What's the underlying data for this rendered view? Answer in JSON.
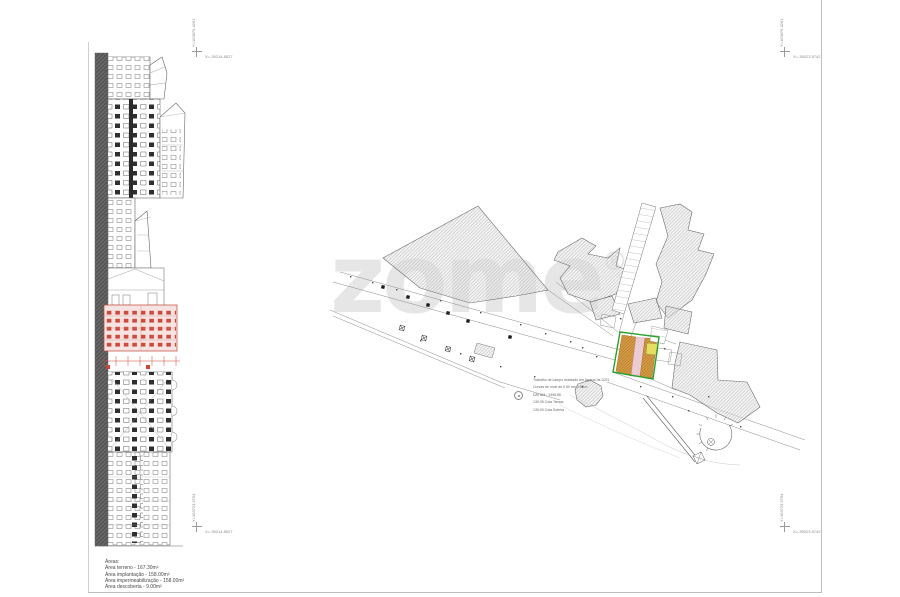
{
  "sheet": {
    "corner_markers": {
      "top_left": {
        "y": "Y=163876.4261",
        "x": "X=-39214.8527"
      },
      "top_right": {
        "y": "Y=163876.4261",
        "x": "X=-39023.5742"
      },
      "bottom_left": {
        "y": "Y=163723.5764",
        "x": "X=-39214.8527"
      },
      "bottom_right": {
        "y": "Y=163723.5764",
        "x": "X=-39023.5742"
      }
    },
    "areas_block": {
      "title": "Áreas:",
      "lines": [
        "Área terreno - 167.30m²",
        "Área implantação - 158.00m²",
        "Área impermeabilização - 158.00m²",
        "Área descoberta - 9.00m²"
      ]
    },
    "watermark": "zome",
    "watermark_reg": "®"
  },
  "site_plan": {
    "legend": {
      "lines": [
        "Trabalho de campo realizado em Agosto de 2021",
        "Curvas de nível de 0.50 em 0.50 m",
        "DATUM - 1995.86",
        "139.05 Cota Tampa",
        "139.00 Cota Soleira"
      ]
    },
    "colors": {
      "plot_outline_green": "#2ca02c",
      "plot_fill_orange": "#d29743",
      "plot_strip_pink": "#eed0d6",
      "plot_square_yellow": "#e4df63",
      "highlight_red": "#cc4437",
      "hatch_gray": "#9a9a9a",
      "watermark_gray": "#e6e6e6"
    }
  }
}
